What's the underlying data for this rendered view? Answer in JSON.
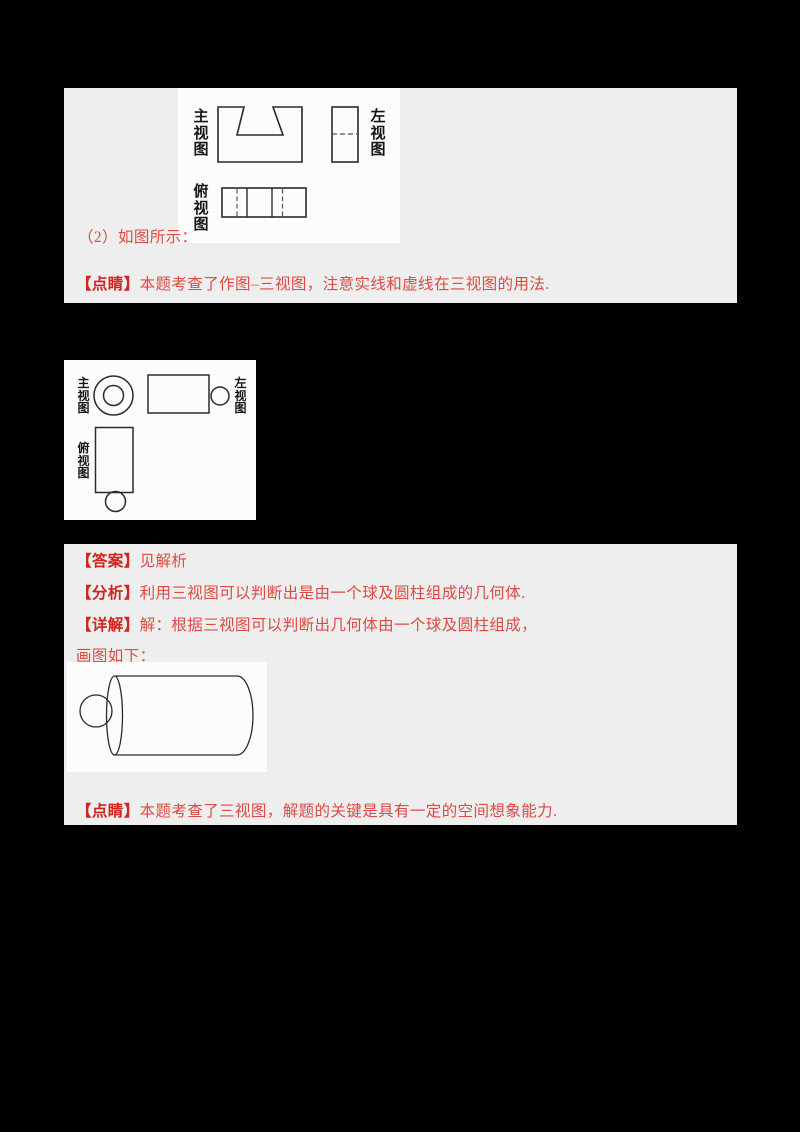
{
  "colors": {
    "background": "#000000",
    "panel": "#eeeeee",
    "image_background": "#fcfcfc",
    "accent_red": "#d2231d",
    "body_red": "#dd4a42",
    "diagram_line": "#2b2b2b"
  },
  "section1": {
    "diagram": {
      "front_label": "主视图",
      "left_label": "左视图",
      "top_label": "俯视图"
    },
    "caption": "（2）如图所示：",
    "note_label": "【点睛】",
    "note_text": "本题考查了作图–三视图，注意实线和虚线在三视图的用法."
  },
  "section2": {
    "diagram": {
      "front_label": "主视图",
      "left_label": "左视图",
      "top_label": "俯视图"
    }
  },
  "section3": {
    "answer_label": "【答案】",
    "answer_text": "见解析",
    "analysis_label": "【分析】",
    "analysis_text": "利用三视图可以判断出是由一个球及圆柱组成的几何体.",
    "detail_label": "【详解】",
    "detail_text": "解：根据三视图可以判断出几何体由一个球及圆柱组成，",
    "figure_caption": "画图如下：",
    "note_label": "【点睛】",
    "note_text": "本题考查了三视图，解题的关键是具有一定的空间想象能力."
  }
}
